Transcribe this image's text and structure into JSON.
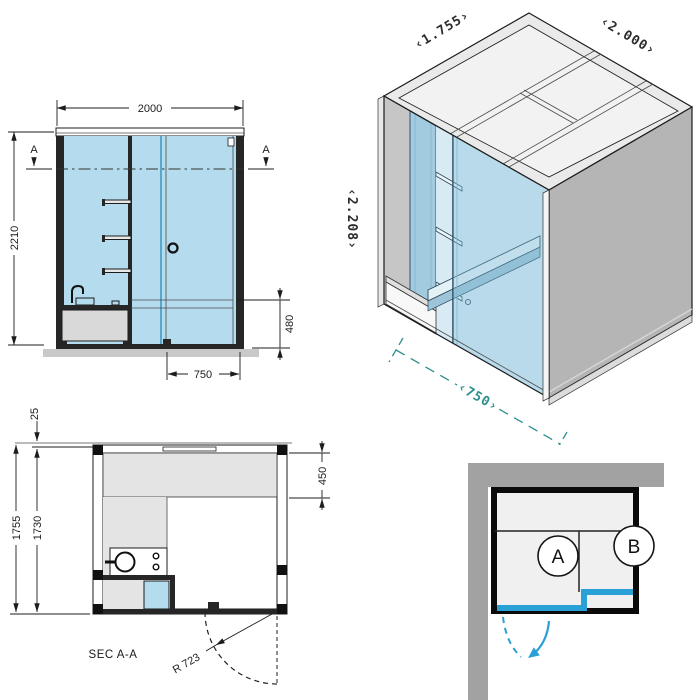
{
  "colors": {
    "glass_blue": "#b5dcee",
    "glass_blue_deep": "#a3cbdf",
    "accent_blue": "#29a0d6",
    "dim_teal": "#2e8f8f",
    "wall_gray": "#b5b5b5",
    "corner_wall_gray": "#a2a2a2",
    "floor_gray": "#c9c9c9"
  },
  "front_elevation": {
    "dim_overall_width": "2000",
    "dim_overall_height": "2210",
    "dim_counter_height": "480",
    "dim_door_width": "750",
    "section_marker_left": "A",
    "section_marker_right": "A"
  },
  "isometric_view": {
    "dim_depth": "‹1.755›",
    "dim_width": "‹2.000›",
    "dim_height": "‹2.208›",
    "dim_door_opening": "‹750›"
  },
  "plan_section": {
    "title": "SEC A-A",
    "dim_roof_overhang": "25",
    "dim_depth_overall": "1755",
    "dim_depth_clear": "1730",
    "dim_bench_depth": "450",
    "dim_door_swing_radius": "R 723"
  },
  "placement_diagram": {
    "zone_a_label": "A",
    "zone_b_label": "B"
  }
}
